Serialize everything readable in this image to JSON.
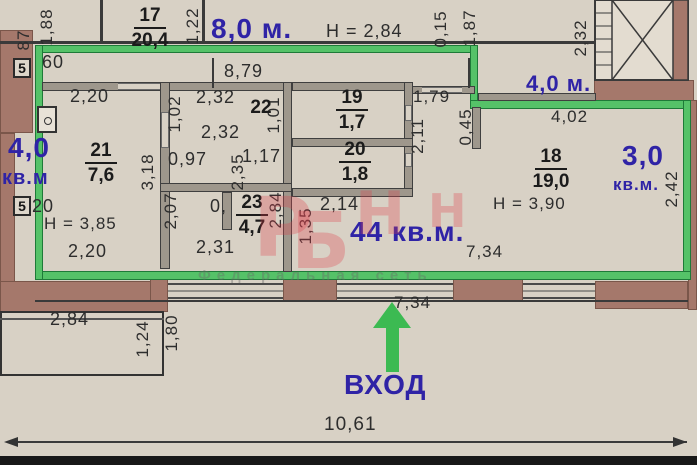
{
  "colors": {
    "accent_blue": "#2f23a6",
    "outline_green": "#55c268",
    "wall_gray": "#9e978c",
    "brick_brown": "#a5786b",
    "dim_text": "#2d2d2d"
  },
  "rooms": [
    {
      "number": "17",
      "area": "20,4",
      "cx": 150,
      "cy": 6
    },
    {
      "number": "21",
      "area": "7,6",
      "cx": 101,
      "cy": 141
    },
    {
      "number": "22",
      "area": "",
      "cx": 261,
      "cy": 98
    },
    {
      "number": "19",
      "area": "1,7",
      "cx": 352,
      "cy": 88
    },
    {
      "number": "20",
      "area": "1,8",
      "cx": 355,
      "cy": 140
    },
    {
      "number": "23",
      "area": "4,7",
      "cx": 252,
      "cy": 193
    },
    {
      "number": "18",
      "area": "19,0",
      "cx": 551,
      "cy": 147
    }
  ],
  "dims_h": [
    {
      "t": "60",
      "x": 42,
      "y": 52,
      "fs": 18
    },
    {
      "t": "2,20",
      "x": 70,
      "y": 86,
      "fs": 18
    },
    {
      "t": "8,79",
      "x": 224,
      "y": 61,
      "fs": 18
    },
    {
      "t": "2,32",
      "x": 196,
      "y": 87,
      "fs": 18
    },
    {
      "t": "2,32",
      "x": 201,
      "y": 122,
      "fs": 18
    },
    {
      "t": "0,97",
      "x": 168,
      "y": 149,
      "fs": 18
    },
    {
      "t": "1,17",
      "x": 242,
      "y": 146,
      "fs": 18
    },
    {
      "t": "0,",
      "x": 210,
      "y": 196,
      "fs": 18
    },
    {
      "t": "2,31",
      "x": 196,
      "y": 237,
      "fs": 18
    },
    {
      "t": "2,20",
      "x": 68,
      "y": 241,
      "fs": 18
    },
    {
      "t": "Н = 3,85",
      "x": 44,
      "y": 214,
      "fs": 17
    },
    {
      "t": "2,14",
      "x": 320,
      "y": 194,
      "fs": 18
    },
    {
      "t": "1,79",
      "x": 413,
      "y": 87,
      "fs": 17
    },
    {
      "t": "4,02",
      "x": 551,
      "y": 107,
      "fs": 17
    },
    {
      "t": "Н = 3,90",
      "x": 493,
      "y": 194,
      "fs": 17
    },
    {
      "t": "7,34",
      "x": 466,
      "y": 242,
      "fs": 17
    },
    {
      "t": "7,34",
      "x": 394,
      "y": 293,
      "fs": 17
    },
    {
      "t": "2,84",
      "x": 50,
      "y": 309,
      "fs": 18
    },
    {
      "t": "10,61",
      "x": 324,
      "y": 414,
      "fs": 19
    },
    {
      "t": "Н = 2,84",
      "x": 326,
      "y": 21,
      "fs": 18
    },
    {
      "t": "20",
      "x": 32,
      "y": 196,
      "fs": 18
    }
  ],
  "dims_v": [
    {
      "t": "87",
      "cx": 24,
      "cy": 40
    },
    {
      "t": "1,88",
      "cx": 47,
      "cy": 27
    },
    {
      "t": "1,22",
      "cx": 193,
      "cy": 26
    },
    {
      "t": "0,15",
      "cx": 441,
      "cy": 29
    },
    {
      "t": "1,87",
      "cx": 470,
      "cy": 28
    },
    {
      "t": "2,32",
      "cx": 581,
      "cy": 38
    },
    {
      "t": "1,02",
      "cx": 175,
      "cy": 114
    },
    {
      "t": "1,01",
      "cx": 274,
      "cy": 115
    },
    {
      "t": "3,18",
      "cx": 148,
      "cy": 172
    },
    {
      "t": "2,07",
      "cx": 171,
      "cy": 211
    },
    {
      "t": "2,35",
      "cx": 238,
      "cy": 172
    },
    {
      "t": "2,84",
      "cx": 276,
      "cy": 210
    },
    {
      "t": "2,11",
      "cx": 418,
      "cy": 136
    },
    {
      "t": "0,45",
      "cx": 466,
      "cy": 127
    },
    {
      "t": "1,35",
      "cx": 306,
      "cy": 226
    },
    {
      "t": "2,42",
      "cx": 672,
      "cy": 189
    },
    {
      "t": "1,24",
      "cx": 143,
      "cy": 339
    },
    {
      "t": "1,80",
      "cx": 172,
      "cy": 333
    }
  ],
  "blue_labels": [
    {
      "t": "8,0 м.",
      "x": 211,
      "y": 13,
      "fs": 28
    },
    {
      "t": "4,0 м.",
      "x": 526,
      "y": 71,
      "fs": 22
    },
    {
      "t": "4,0",
      "x": 8,
      "y": 132,
      "fs": 28
    },
    {
      "t": "кв.м",
      "x": 2,
      "y": 167,
      "fs": 20
    },
    {
      "t": "3,0",
      "x": 622,
      "y": 140,
      "fs": 28
    },
    {
      "t": "кв.м.",
      "x": 613,
      "y": 175,
      "fs": 17
    },
    {
      "t": "44 кв.м.",
      "x": 350,
      "y": 216,
      "fs": 28
    },
    {
      "t": "ВХОД",
      "x": 344,
      "y": 369,
      "fs": 28
    }
  ],
  "markers": [
    {
      "t": "5",
      "x": 13,
      "y": 58
    },
    {
      "t": "5",
      "x": 13,
      "y": 196
    }
  ],
  "watermark": {
    "pink_letters": [
      {
        "t": "Р",
        "x": 253,
        "y": 188,
        "fs": 82
      },
      {
        "t": "Б",
        "x": 291,
        "y": 203,
        "fs": 78
      },
      {
        "t": "Н",
        "x": 355,
        "y": 184,
        "fs": 60
      },
      {
        "t": "Н",
        "x": 428,
        "y": 188,
        "fs": 46
      }
    ],
    "gray_text": "Федеральная сеть"
  }
}
